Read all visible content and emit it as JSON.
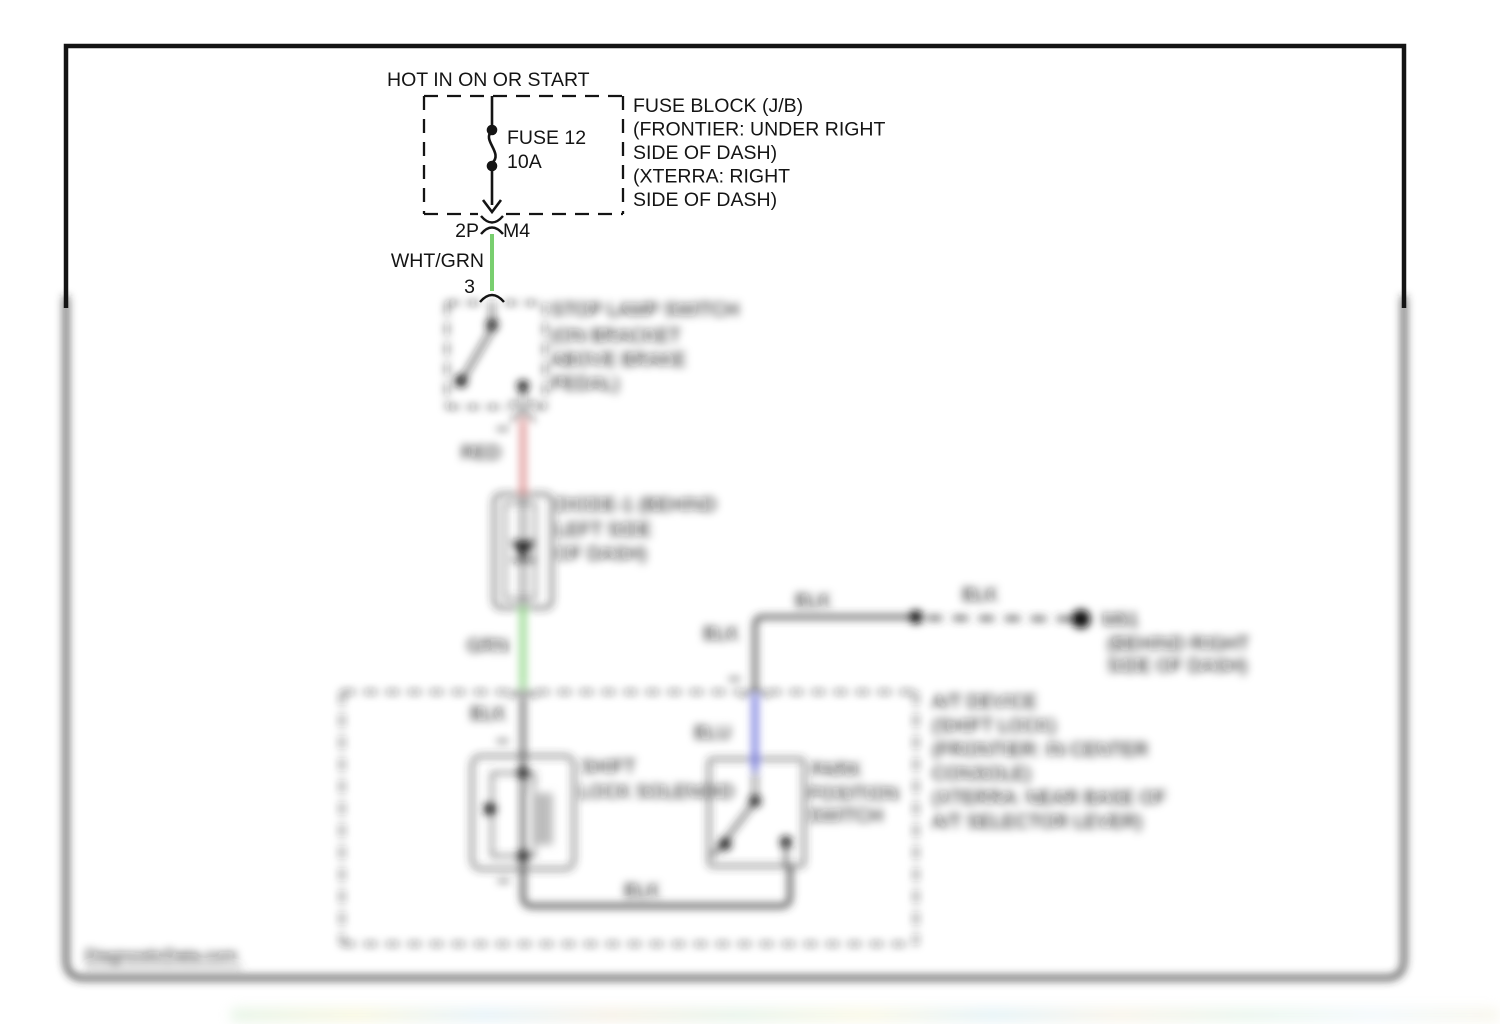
{
  "diagram": {
    "power_source": "HOT IN ON OR START",
    "fuse": {
      "name": "FUSE 12",
      "rating": "10A"
    },
    "fuse_block_note": [
      "FUSE BLOCK (J/B)",
      "(FRONTIER: UNDER RIGHT",
      "SIDE OF DASH)",
      "(XTERRA: RIGHT",
      "SIDE OF DASH)"
    ],
    "connector": {
      "pins": "2P",
      "id": "M4",
      "terminal": "3"
    },
    "wire_labels": {
      "wht_grn": "WHT/GRN",
      "red": "RED",
      "grn": "GRN",
      "blk": "BLK",
      "blu": "BLU"
    },
    "stop_lamp_switch_note": [
      "STOP LAMP SWITCH",
      "(ON BRACKET",
      "ABOVE BRAKE",
      "PEDAL)"
    ],
    "diode_note": [
      "DIODE-1 (BEHIND",
      "LEFT SIDE",
      "OF DASH)"
    ],
    "ground": {
      "id": "M61",
      "note": [
        "(BEHIND RIGHT",
        "SIDE OF DASH)"
      ]
    },
    "at_device_note": [
      "A/T DEVICE",
      "(SHIFT LOCK)",
      "(FRONTIER: IN CENTER",
      "CONSOLE)",
      "(XTERRA: NEAR BASE OF",
      "A/T SELECTOR LEVER)"
    ],
    "solenoid_note": [
      "SHIFT",
      "LOCK SOLENOID"
    ],
    "park_switch_note": [
      "PARK",
      "POSITION",
      "SWITCH"
    ]
  },
  "watermark": "DiagnosticData.com",
  "colors": {
    "wire_green": "#79cf6f",
    "wire_red": "#d97d7d",
    "wire_blue": "#5a5ed8",
    "wire_dark": "#3a3a3a"
  }
}
